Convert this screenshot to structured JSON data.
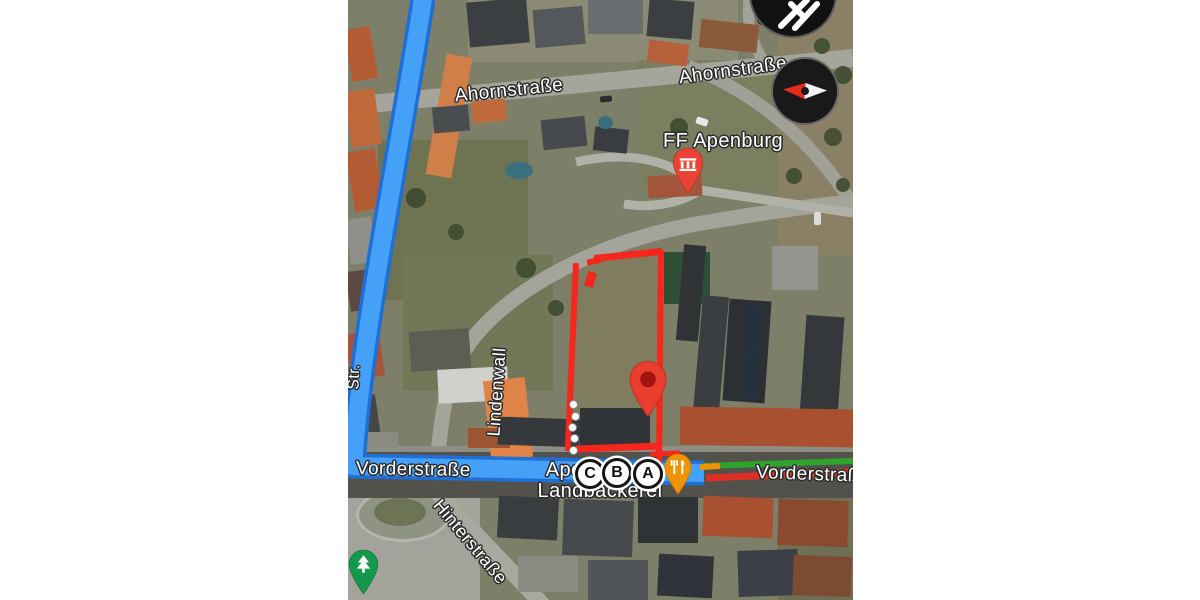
{
  "map": {
    "street_labels": {
      "badeler": "Badeler Str",
      "badeler_partial": "Str.",
      "ahornstrasse": "Ahornstraße",
      "ahornstrasse_2": "Ahornstraße",
      "oken_partial": "oken",
      "lindenwall": "Lindenwall",
      "hinterstrasse": "Hinterstraße",
      "vorderstrasse_left": "Vorderstraße",
      "vorderstrasse_right": "Vorderstraße"
    },
    "pois": {
      "fire_station": {
        "label": "FF Apenburg",
        "marker_color": "#e94335"
      },
      "bakery": {
        "name_line1": "Apenburger",
        "name_line2": "Landbäckerei",
        "marker_color": "#f09300"
      },
      "park_marker_color": "#13984c"
    },
    "transit_stops": [
      {
        "letter": "C"
      },
      {
        "letter": "B"
      },
      {
        "letter": "A"
      }
    ],
    "route": {
      "highlight_blue": "#45a1f7",
      "highlight_blue_edge": "#1f6fd6",
      "traffic_green": "#2fa42b",
      "traffic_red": "#dd2f23",
      "traffic_orange": "#f09300"
    },
    "selection_outline_color": "#f5261b",
    "compass": {
      "north_color": "#e8291d"
    }
  }
}
